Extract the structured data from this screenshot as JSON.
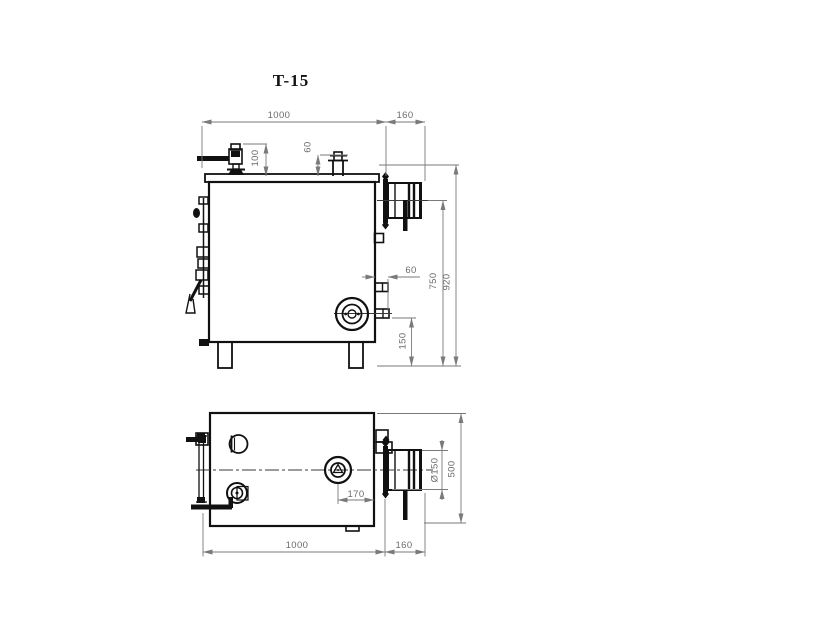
{
  "title": "T-15",
  "colors": {
    "object_line": "#111111",
    "dimension_line": "#7a7a7a",
    "dimension_text": "#6b6b6b",
    "background": "#ffffff"
  },
  "front_view": {
    "name": "front elevation",
    "dims": {
      "body_width": "1000",
      "outlet_length": "160",
      "valve_offset": "100",
      "filler_offset": "60",
      "side_nozzle_length": "60",
      "outlet_axis_height": "750",
      "overall_height": "920",
      "drain_axis_height": "150"
    }
  },
  "plan_view": {
    "name": "plan view",
    "dims": {
      "flange_offset": "170",
      "outlet_diameter": "Ø150",
      "body_depth": "500",
      "body_width": "1000",
      "outlet_length": "160"
    }
  }
}
